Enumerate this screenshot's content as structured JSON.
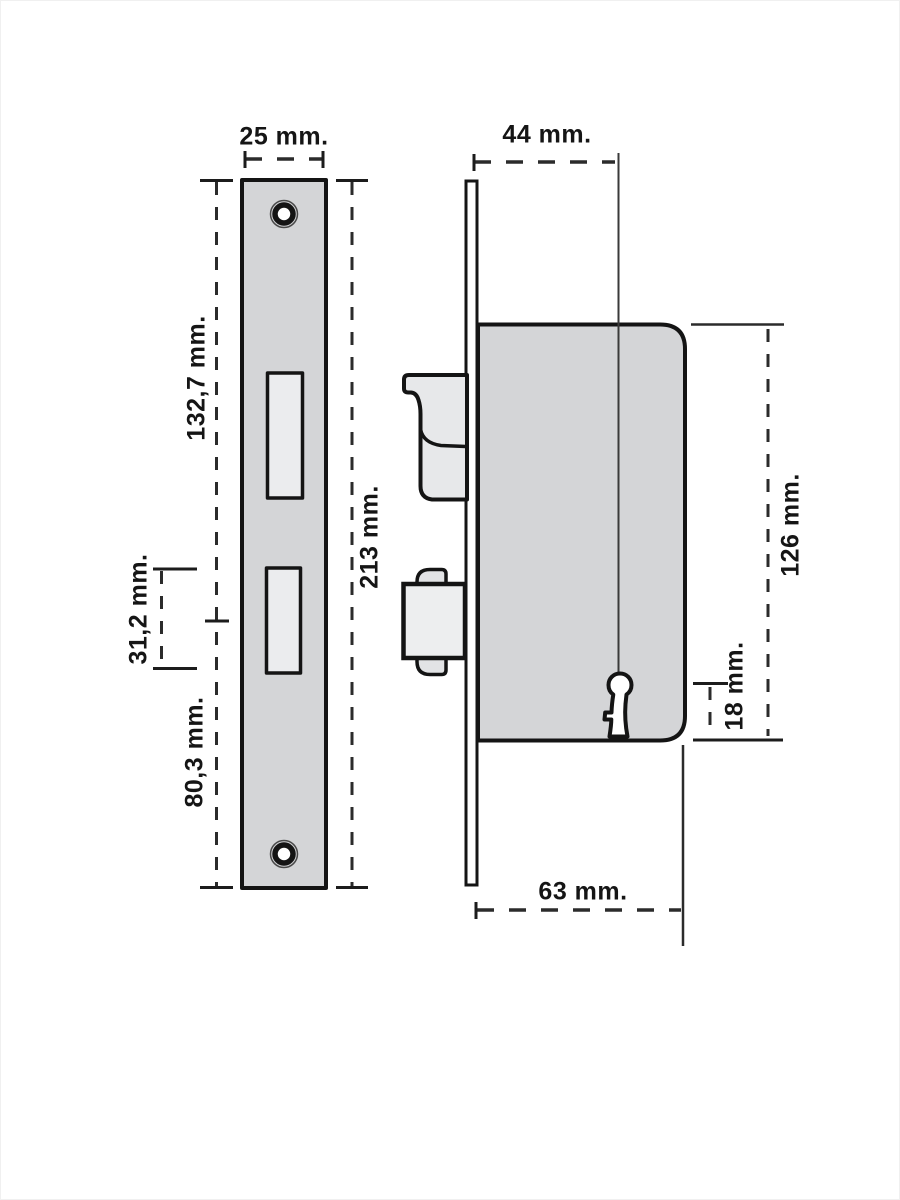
{
  "diagram": {
    "kind": "technical dimension drawing",
    "subject": "mortise door lock: strike plate (left view) and lock case with latch, deadbolt and keyhole (right view)"
  },
  "colors": {
    "background": "#ffffff",
    "outline": "#141414",
    "dimension_line": "#2b2b2b",
    "steel_gray": "#d4d5d7",
    "cutout_gray": "#ebecee",
    "latch_gray": "#e7e8ea",
    "bolt_gray": "#edeeef",
    "faceplate_white": "#fdfdfd"
  },
  "strike_plate": {
    "width_label": "25 mm.",
    "upper_section_label": "132,7 mm.",
    "cutout_height_label": "31,2 mm.",
    "lower_section_label": "80,3 mm.",
    "total_height_label": "213 mm."
  },
  "lock_case": {
    "backset_label": "44 mm.",
    "height_label": "126 mm.",
    "keyhole_offset_label": "18 mm.",
    "depth_label": "63 mm."
  }
}
